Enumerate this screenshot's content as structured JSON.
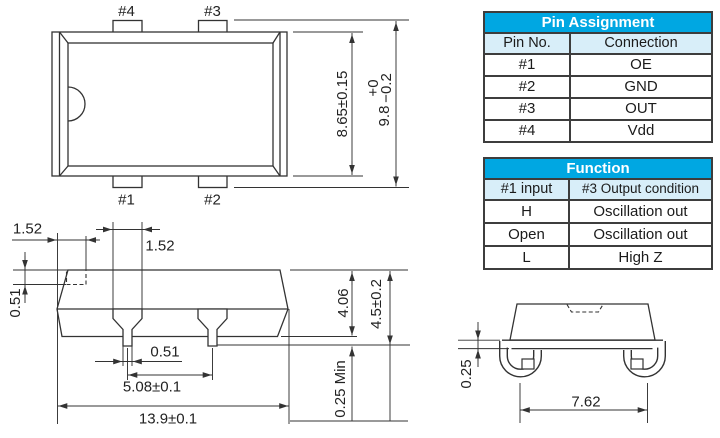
{
  "colors": {
    "table_header_bg": "#00A7E2",
    "table_header_text": "#FFFFFF",
    "table_subheader_bg": "#D8EEF9",
    "drawing_line": "#333333"
  },
  "top_view": {
    "pad4": "#4",
    "pad3": "#3",
    "pad1": "#1",
    "pad2": "#2",
    "dim_body_height": "8.65±0.15",
    "dim_overall_main": "9.8",
    "dim_overall_plus": "+0",
    "dim_overall_minus": "−0.2"
  },
  "side_view": {
    "dim_end_to_pad": "1.52",
    "dim_pad_width": "1.52",
    "dim_pad_thickness": "0.51",
    "dim_lead_width": "0.51",
    "dim_lead_pitch": "5.08±0.1",
    "dim_overall_length": "13.9±0.1",
    "dim_body_height": "4.06",
    "dim_overall_height": "4.5±0.2",
    "dim_standoff": "0.25 Min"
  },
  "end_view": {
    "dim_lead_thickness": "0.25",
    "dim_lead_span": "7.62"
  },
  "pin_table": {
    "title": "Pin Assignment",
    "col1": "Pin No.",
    "col2": "Connection",
    "rows": [
      {
        "pin": "#1",
        "conn": "OE"
      },
      {
        "pin": "#2",
        "conn": "GND"
      },
      {
        "pin": "#3",
        "conn": "OUT"
      },
      {
        "pin": "#4",
        "conn": "Vdd"
      }
    ]
  },
  "function_table": {
    "title": "Function",
    "col1": "#1 input",
    "col2": "#3 Output condition",
    "rows": [
      {
        "input": "H",
        "output": "Oscillation out"
      },
      {
        "input": "Open",
        "output": "Oscillation out"
      },
      {
        "input": "L",
        "output": "High Z"
      }
    ]
  }
}
